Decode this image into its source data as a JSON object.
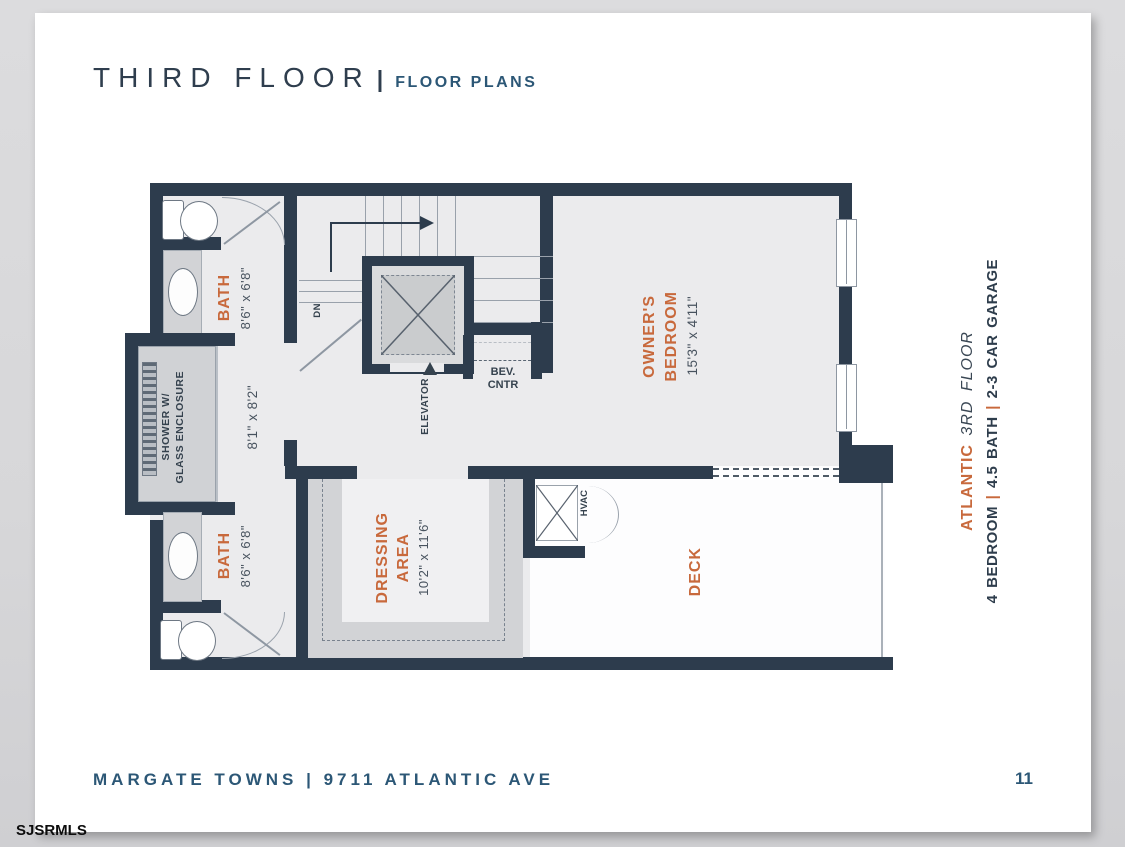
{
  "header": {
    "title": "THIRD FLOOR",
    "separator": "|",
    "subtitle": "FLOOR PLANS"
  },
  "footer": {
    "text": "MARGATE TOWNS | 9711 ATLANTIC AVE",
    "page_number": "11"
  },
  "watermark": "SJSRMLS",
  "sidebar": {
    "plan_name": "ATLANTIC",
    "floor": "3RD FLOOR",
    "spec_bedroom": "4 BEDROOM",
    "spec_bath": "4.5 BATH",
    "spec_garage": "2-3 CAR GARAGE",
    "separator": "|"
  },
  "plan": {
    "bath_upper": {
      "label": "BATH",
      "dims": "8'6\" x 6'8\""
    },
    "bath_lower": {
      "label": "BATH",
      "dims": "8'6\" x 6'8\""
    },
    "shower": {
      "line1": "SHOWER W/",
      "line2": "GLASS ENCLOSURE"
    },
    "hall": {
      "dims": "8'1\" x 8'2\""
    },
    "stairs": {
      "down_label": "DN"
    },
    "elevator": {
      "label": "ELEVATOR"
    },
    "bev_center": {
      "line1": "BEV.",
      "line2": "CNTR"
    },
    "owners_bedroom": {
      "line1": "OWNER'S",
      "line2": "BEDROOM",
      "dims": "15'3\" x 4'11\""
    },
    "dressing_area": {
      "line1": "DRESSING",
      "line2": "AREA",
      "dims": "10'2\" x 11'6\""
    },
    "hvac": {
      "label": "HVAC"
    },
    "deck": {
      "label": "DECK"
    }
  },
  "colors": {
    "wall_navy": "#2d3c4d",
    "accent_orange": "#c8693c",
    "dims_navy": "#47525e",
    "title_navy": "#2f3e4e",
    "steel_blue": "#2c5776",
    "room_fill": "#ebebed",
    "fixture_gray": "#d2d3d6"
  }
}
